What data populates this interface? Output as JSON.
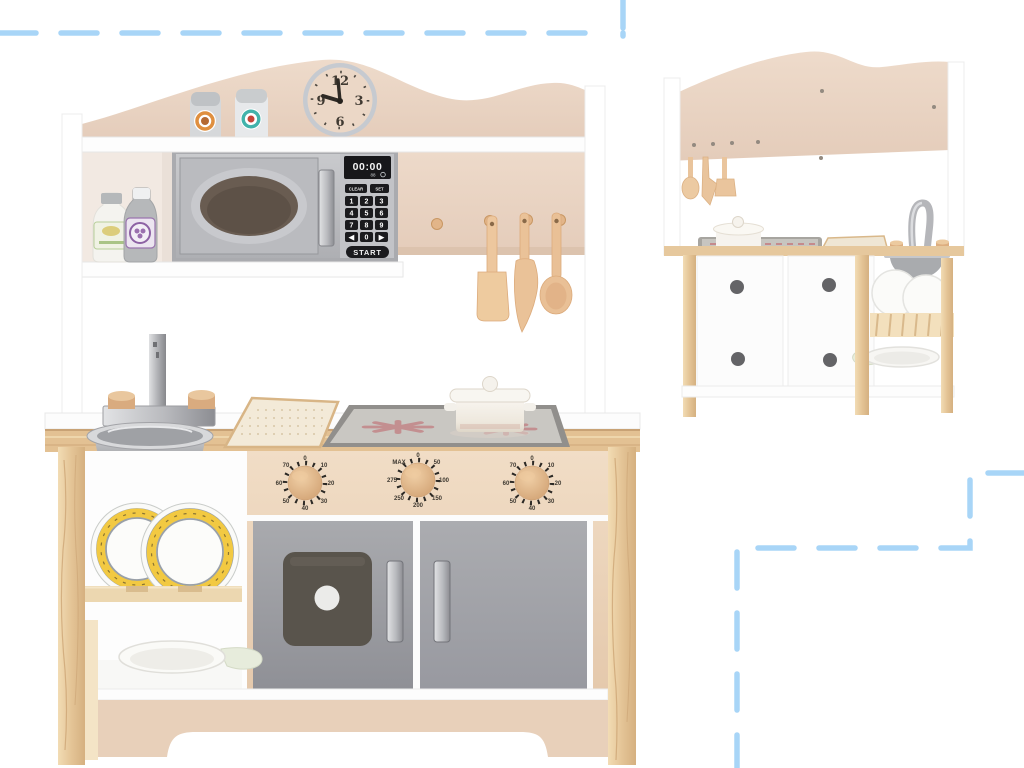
{
  "image": {
    "type": "product-photo",
    "subject": "Wooden toy play kitchen with clock, microwave, sink, stove and oven - front view and rear view",
    "background": "#ffffff"
  },
  "decor": {
    "dash_color": "#a8d5f7"
  },
  "palette": {
    "panel_beige": "#e9d4c4",
    "apron_beige": "#ecd7c0",
    "kick_beige": "#e8d0ba",
    "door_gray": "#9da0a6",
    "silver": "#c9cbcf",
    "wood_light": "#e6c497",
    "wood_utensil": "#ecc69c",
    "stove_inner": "#c9c7c2",
    "burner_pink": "#c28587",
    "plate_yellow": "#f2c942",
    "display_black": "#17171a"
  },
  "clock": {
    "numerals": [
      "12",
      "3",
      "6",
      "9"
    ]
  },
  "microwave": {
    "display": "00:00",
    "display_sub": "88",
    "clear_label": "CLEAR",
    "set_label": "SET",
    "keys": [
      "1",
      "2",
      "3",
      "4",
      "5",
      "6",
      "7",
      "8",
      "9",
      "◀",
      "0",
      "▶"
    ],
    "start_label": "START"
  },
  "stove_knobs": {
    "left": [
      "0",
      "10",
      "20",
      "30",
      "40",
      "50",
      "60",
      "70"
    ],
    "center": [
      "0",
      "50",
      "100",
      "150",
      "200",
      "250",
      "275",
      "MAX"
    ],
    "right": [
      "0",
      "10",
      "20",
      "30",
      "40",
      "50",
      "60",
      "70"
    ]
  }
}
